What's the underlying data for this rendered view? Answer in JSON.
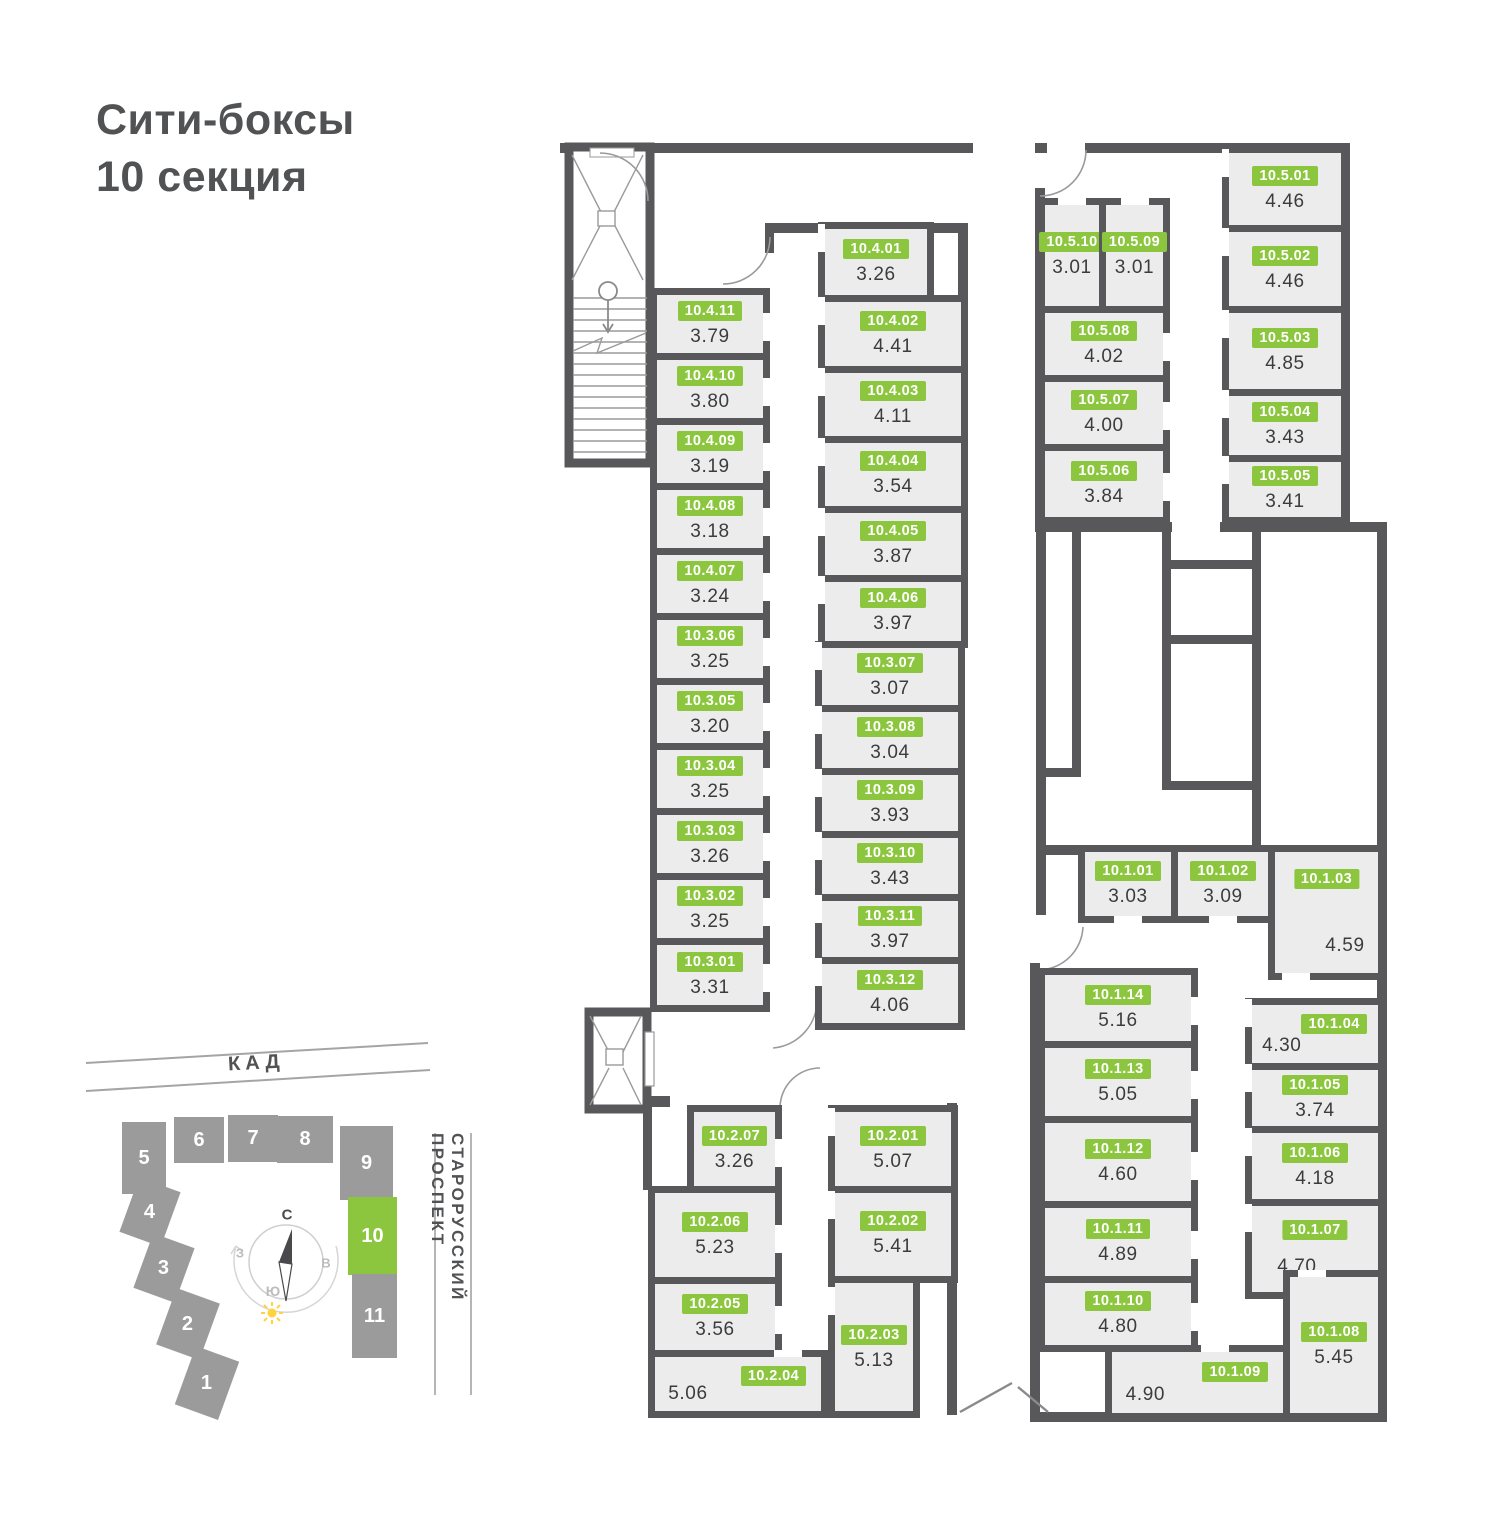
{
  "title": {
    "line1": "Сити-боксы",
    "line2": "10 секция"
  },
  "colors": {
    "accent_green": "#8CC63F",
    "wall_gray": "#58585A",
    "room_fill": "#ECECEC",
    "building_gray": "#9B9B9B",
    "sun_yellow": "#FFD23F"
  },
  "floor_plan": {
    "rooms": [
      {
        "id": "10.4.11",
        "area": "3.79",
        "x": 650,
        "y": 288,
        "w": 120,
        "h": 72,
        "door": "r"
      },
      {
        "id": "10.4.10",
        "area": "3.80",
        "x": 650,
        "y": 353,
        "w": 120,
        "h": 72,
        "door": "r"
      },
      {
        "id": "10.4.09",
        "area": "3.19",
        "x": 650,
        "y": 418,
        "w": 120,
        "h": 72,
        "door": "r"
      },
      {
        "id": "10.4.08",
        "area": "3.18",
        "x": 650,
        "y": 483,
        "w": 120,
        "h": 72,
        "door": "r"
      },
      {
        "id": "10.4.07",
        "area": "3.24",
        "x": 650,
        "y": 548,
        "w": 120,
        "h": 72,
        "door": "r"
      },
      {
        "id": "10.3.06",
        "area": "3.25",
        "x": 650,
        "y": 613,
        "w": 120,
        "h": 72,
        "door": "r"
      },
      {
        "id": "10.3.05",
        "area": "3.20",
        "x": 650,
        "y": 678,
        "w": 120,
        "h": 72,
        "door": "r"
      },
      {
        "id": "10.3.04",
        "area": "3.25",
        "x": 650,
        "y": 743,
        "w": 120,
        "h": 72,
        "door": "r"
      },
      {
        "id": "10.3.03",
        "area": "3.26",
        "x": 650,
        "y": 808,
        "w": 120,
        "h": 72,
        "door": "r"
      },
      {
        "id": "10.3.02",
        "area": "3.25",
        "x": 650,
        "y": 873,
        "w": 120,
        "h": 72,
        "door": "r"
      },
      {
        "id": "10.3.01",
        "area": "3.31",
        "x": 650,
        "y": 938,
        "w": 120,
        "h": 74,
        "door": "r"
      },
      {
        "id": "10.4.01",
        "area": "3.26",
        "x": 818,
        "y": 222,
        "w": 116,
        "h": 80,
        "door": "l"
      },
      {
        "id": "10.4.02",
        "area": "4.41",
        "x": 818,
        "y": 295,
        "w": 150,
        "h": 78,
        "door": "l"
      },
      {
        "id": "10.4.03",
        "area": "4.11",
        "x": 818,
        "y": 366,
        "w": 150,
        "h": 77,
        "door": "l"
      },
      {
        "id": "10.4.04",
        "area": "3.54",
        "x": 818,
        "y": 436,
        "w": 150,
        "h": 77,
        "door": "l"
      },
      {
        "id": "10.4.05",
        "area": "3.87",
        "x": 818,
        "y": 506,
        "w": 150,
        "h": 76,
        "door": "l"
      },
      {
        "id": "10.4.06",
        "area": "3.97",
        "x": 818,
        "y": 575,
        "w": 150,
        "h": 73,
        "door": "l"
      },
      {
        "id": "10.3.07",
        "area": "3.07",
        "x": 815,
        "y": 641,
        "w": 150,
        "h": 71,
        "door": "l"
      },
      {
        "id": "10.3.08",
        "area": "3.04",
        "x": 815,
        "y": 705,
        "w": 150,
        "h": 70,
        "door": "l"
      },
      {
        "id": "10.3.09",
        "area": "3.93",
        "x": 815,
        "y": 768,
        "w": 150,
        "h": 70,
        "door": "l"
      },
      {
        "id": "10.3.10",
        "area": "3.43",
        "x": 815,
        "y": 831,
        "w": 150,
        "h": 70,
        "door": "l"
      },
      {
        "id": "10.3.11",
        "area": "3.97",
        "x": 815,
        "y": 894,
        "w": 150,
        "h": 70,
        "door": "l"
      },
      {
        "id": "10.3.12",
        "area": "4.06",
        "x": 815,
        "y": 957,
        "w": 150,
        "h": 73,
        "door": "l"
      },
      {
        "id": "10.2.07",
        "area": "3.26",
        "x": 687,
        "y": 1105,
        "w": 95,
        "h": 88,
        "door": "r"
      },
      {
        "id": "10.2.06",
        "area": "5.23",
        "x": 648,
        "y": 1186,
        "w": 134,
        "h": 98,
        "door": "r"
      },
      {
        "id": "10.2.05",
        "area": "3.56",
        "x": 648,
        "y": 1277,
        "w": 134,
        "h": 80,
        "door": "r"
      },
      {
        "id": "10.2.04",
        "area": "5.06",
        "x": 648,
        "y": 1350,
        "w": 180,
        "h": 68,
        "door": "t",
        "dp": 0.8,
        "v": "corner"
      },
      {
        "id": "10.2.01",
        "area": "5.07",
        "x": 828,
        "y": 1105,
        "w": 130,
        "h": 88,
        "door": "l"
      },
      {
        "id": "10.2.02",
        "area": "5.41",
        "x": 828,
        "y": 1186,
        "w": 130,
        "h": 97,
        "door": "l"
      },
      {
        "id": "10.2.03",
        "area": "5.13",
        "x": 828,
        "y": 1276,
        "w": 92,
        "h": 142,
        "door": "l",
        "v": "top"
      },
      {
        "id": "10.5.10",
        "area": "3.01",
        "x": 1038,
        "y": 198,
        "w": 68,
        "h": 115,
        "door": "t"
      },
      {
        "id": "10.5.09",
        "area": "3.01",
        "x": 1099,
        "y": 198,
        "w": 71,
        "h": 115,
        "door": "t"
      },
      {
        "id": "10.5.08",
        "area": "4.02",
        "x": 1038,
        "y": 306,
        "w": 132,
        "h": 76,
        "door": "r"
      },
      {
        "id": "10.5.07",
        "area": "4.00",
        "x": 1038,
        "y": 375,
        "w": 132,
        "h": 76,
        "door": "r"
      },
      {
        "id": "10.5.06",
        "area": "3.84",
        "x": 1038,
        "y": 444,
        "w": 132,
        "h": 80,
        "door": "r"
      },
      {
        "id": "10.5.01",
        "area": "4.46",
        "x": 1222,
        "y": 146,
        "w": 126,
        "h": 86,
        "door": "l"
      },
      {
        "id": "10.5.02",
        "area": "4.46",
        "x": 1222,
        "y": 225,
        "w": 126,
        "h": 88,
        "door": "l"
      },
      {
        "id": "10.5.03",
        "area": "4.85",
        "x": 1222,
        "y": 306,
        "w": 126,
        "h": 90,
        "door": "l"
      },
      {
        "id": "10.5.04",
        "area": "3.43",
        "x": 1222,
        "y": 389,
        "w": 126,
        "h": 73,
        "door": "l"
      },
      {
        "id": "10.5.05",
        "area": "3.41",
        "x": 1222,
        "y": 455,
        "w": 126,
        "h": 69,
        "door": "l"
      },
      {
        "id": "10.1.01",
        "area": "3.03",
        "x": 1078,
        "y": 845,
        "w": 100,
        "h": 78,
        "door": "b"
      },
      {
        "id": "10.1.02",
        "area": "3.09",
        "x": 1171,
        "y": 845,
        "w": 104,
        "h": 78,
        "door": "b"
      },
      {
        "id": "10.1.03",
        "area": "4.59",
        "x": 1268,
        "y": 845,
        "w": 117,
        "h": 135,
        "door": "b",
        "dp": 0.2,
        "v": "tall"
      },
      {
        "id": "10.1.14",
        "area": "5.16",
        "x": 1038,
        "y": 968,
        "w": 160,
        "h": 80,
        "door": "r"
      },
      {
        "id": "10.1.13",
        "area": "5.05",
        "x": 1038,
        "y": 1041,
        "w": 160,
        "h": 82,
        "door": "r"
      },
      {
        "id": "10.1.12",
        "area": "4.60",
        "x": 1038,
        "y": 1116,
        "w": 160,
        "h": 92,
        "door": "r"
      },
      {
        "id": "10.1.11",
        "area": "4.89",
        "x": 1038,
        "y": 1201,
        "w": 160,
        "h": 82,
        "door": "r"
      },
      {
        "id": "10.1.10",
        "area": "4.80",
        "x": 1038,
        "y": 1276,
        "w": 160,
        "h": 76,
        "door": "r"
      },
      {
        "id": "10.1.09",
        "area": "4.90",
        "x": 1105,
        "y": 1345,
        "w": 185,
        "h": 75,
        "door": "t",
        "dp": 0.6,
        "v": "corner"
      },
      {
        "id": "10.1.04",
        "area": "4.30",
        "x": 1245,
        "y": 998,
        "w": 140,
        "h": 72,
        "door": "l",
        "v": "corner"
      },
      {
        "id": "10.1.05",
        "area": "3.74",
        "x": 1245,
        "y": 1063,
        "w": 140,
        "h": 70,
        "door": "l"
      },
      {
        "id": "10.1.06",
        "area": "4.18",
        "x": 1245,
        "y": 1126,
        "w": 140,
        "h": 80,
        "door": "l"
      },
      {
        "id": "10.1.07",
        "area": "4.70",
        "x": 1245,
        "y": 1199,
        "w": 140,
        "h": 100,
        "door": "l",
        "v": "area-left"
      },
      {
        "id": "10.1.08",
        "area": "5.45",
        "x": 1283,
        "y": 1270,
        "w": 102,
        "h": 150,
        "door": "t",
        "dp": 0.25
      }
    ]
  },
  "site_plan": {
    "road_label": "КАД",
    "street_label": "СТАРОРУССКИЙ ПРОСПЕКТ",
    "highlighted_building": "10",
    "compass": {
      "n": "С",
      "w": "З",
      "e": "В",
      "s": "Ю"
    },
    "buildings": [
      {
        "label": "5",
        "x": 122,
        "y": 1122,
        "w": 44,
        "h": 72,
        "rot": 0
      },
      {
        "label": "6",
        "x": 174,
        "y": 1117,
        "w": 50,
        "h": 46,
        "rot": 0
      },
      {
        "label": "7",
        "x": 228,
        "y": 1115,
        "w": 50,
        "h": 47,
        "rot": 0
      },
      {
        "label": "8",
        "x": 277,
        "y": 1116,
        "w": 56,
        "h": 47,
        "rot": 0
      },
      {
        "label": "9",
        "x": 340,
        "y": 1126,
        "w": 53,
        "h": 74,
        "rot": 0
      },
      {
        "label": "10",
        "x": 348,
        "y": 1197,
        "w": 49,
        "h": 78,
        "rot": 0,
        "highlight": true
      },
      {
        "label": "11",
        "x": 352,
        "y": 1274,
        "w": 45,
        "h": 84,
        "rot": 0
      },
      {
        "label": "4",
        "x": 128,
        "y": 1183,
        "w": 44,
        "h": 58,
        "rot": 20
      },
      {
        "label": "3",
        "x": 142,
        "y": 1239,
        "w": 44,
        "h": 58,
        "rot": 20
      },
      {
        "label": "2",
        "x": 165,
        "y": 1294,
        "w": 46,
        "h": 60,
        "rot": 20
      },
      {
        "label": "1",
        "x": 184,
        "y": 1352,
        "w": 46,
        "h": 62,
        "rot": 20
      }
    ]
  }
}
